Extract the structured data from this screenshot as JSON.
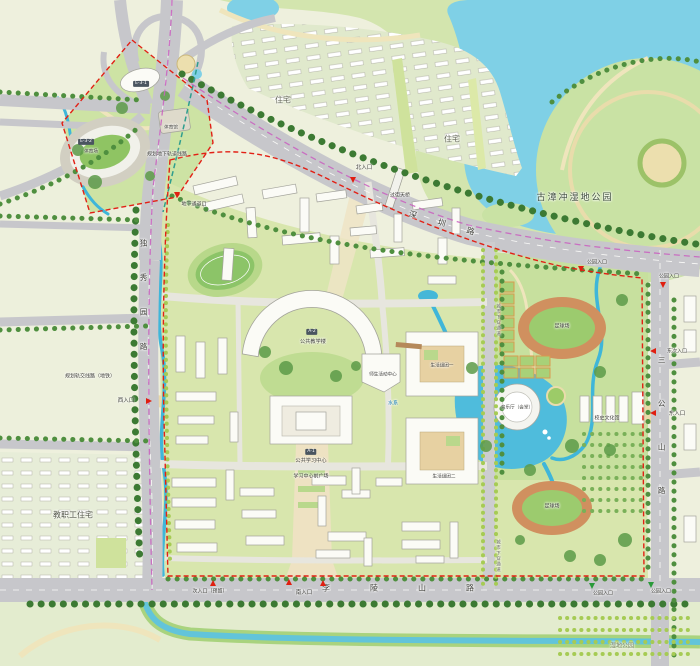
{
  "parks": {
    "wetland": "古漳冲湿地公园",
    "bottom": "湿地公园"
  },
  "residential": {
    "top": "住宅",
    "faculty": "教职工住宅"
  },
  "roads": {
    "shenzhen": "深圳路",
    "duxiuyuan": "独秀园路",
    "sangongshan": "三公山路",
    "lilingshan": "李陵山路",
    "underpass": "城市下穿通道"
  },
  "rail": {
    "underground": "规划地下轨道线路",
    "metro": "规划轨交线路（地铁）"
  },
  "entrances": {
    "north": "北入口",
    "south": "南入口",
    "west": "西入口",
    "east": "东入口",
    "east_secondary": "东次入口",
    "south_reserved": "次入口（预留）",
    "park": "公园入口",
    "tunnel": "地下通道口",
    "footbridge": "过街天桥"
  },
  "buildings": {
    "a2_badge": "A-2",
    "a2": "公共教学楼",
    "a1_badge": "A-1",
    "a1": "公共学习中心",
    "plaza": "学习中心前广场",
    "activity": "师生活动中心",
    "music": "音乐厅（会堂）",
    "history": "校史文化馆",
    "e31_badge": "E-3-1",
    "e32_badge": "E-3-2",
    "stadium": "体育场",
    "gym": "体育馆",
    "dorm1": "生活组团一",
    "dorm2": "生活组团二"
  },
  "fields": {
    "football": "足球场"
  },
  "water": {
    "system": "水系"
  },
  "colors": {
    "lake": "#7fd0e6",
    "stream": "#3fb6d9",
    "campus_green": "#d8e6ad",
    "road": "#c7c7cb",
    "boundary_red": "#e22015",
    "metro_pink": "#c95fc0",
    "track": "#d0905f",
    "field_green": "#9ccb6e"
  }
}
